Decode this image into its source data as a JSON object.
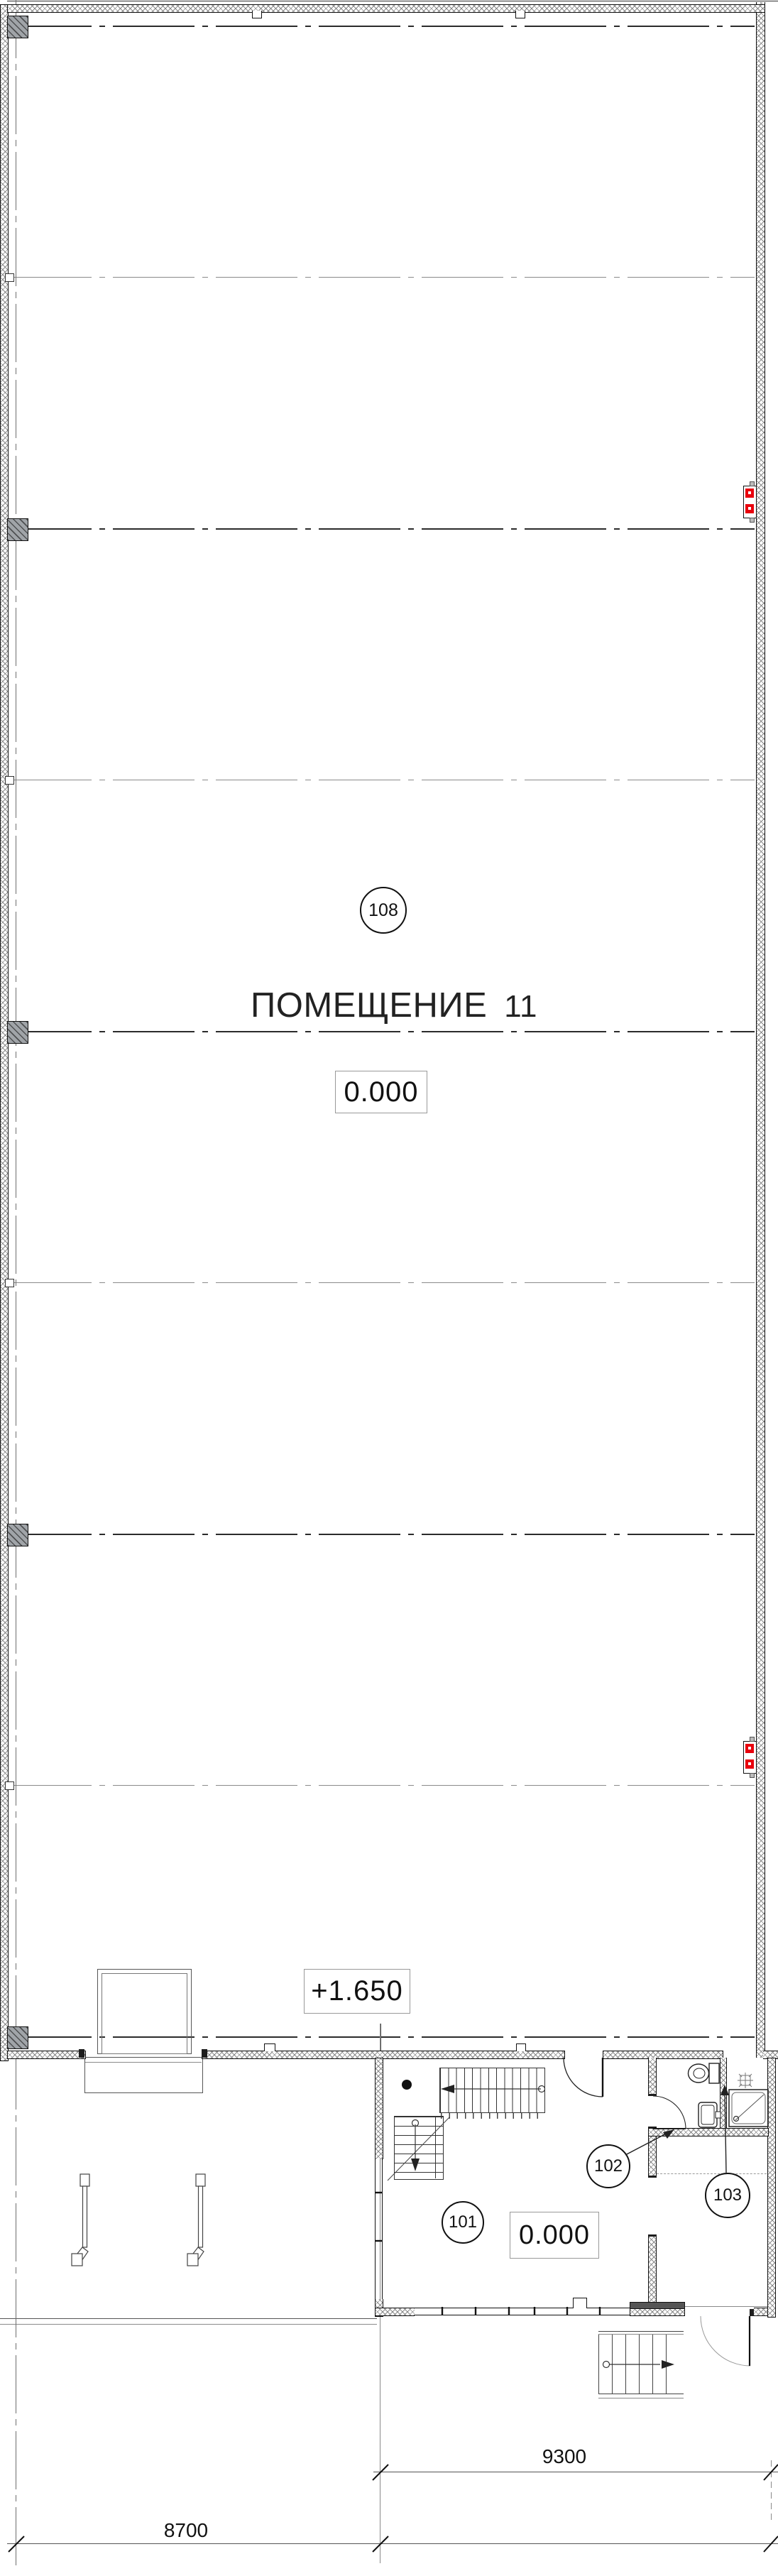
{
  "drawing_type": "architectural floor plan",
  "labels": {
    "hall_name": "ПОМЕЩЕНИЕ",
    "hall_number": "11",
    "hall_room_tag": "108",
    "hall_level": "0.000",
    "mezzanine_level": "+1.650",
    "room101_tag": "101",
    "room101_level": "0.000",
    "room102_tag": "102",
    "room103_tag": "103"
  },
  "dimensions": {
    "annex_width_mm": "9300",
    "dock_width_mm": "8700"
  },
  "colors": {
    "fire_cabinet_red": "#e8000d",
    "line_black": "#1d1d1d",
    "line_gray": "#8a8a8a",
    "column_fill": "#a0a4a8"
  },
  "icons": {
    "fire_hose_cabinet": "red double-square wall cabinet on right wall",
    "toilet": "oval bowl with cistern",
    "sink": "rounded rectangle washbasin",
    "shower_tray": "square tray with diagonal and drain",
    "ceiling_light": "crossed square symbol",
    "stair_walk_line": "circle-start line with arrow",
    "column": "hatched grey square on grid line",
    "dock_bumper": "post with angled foot"
  }
}
